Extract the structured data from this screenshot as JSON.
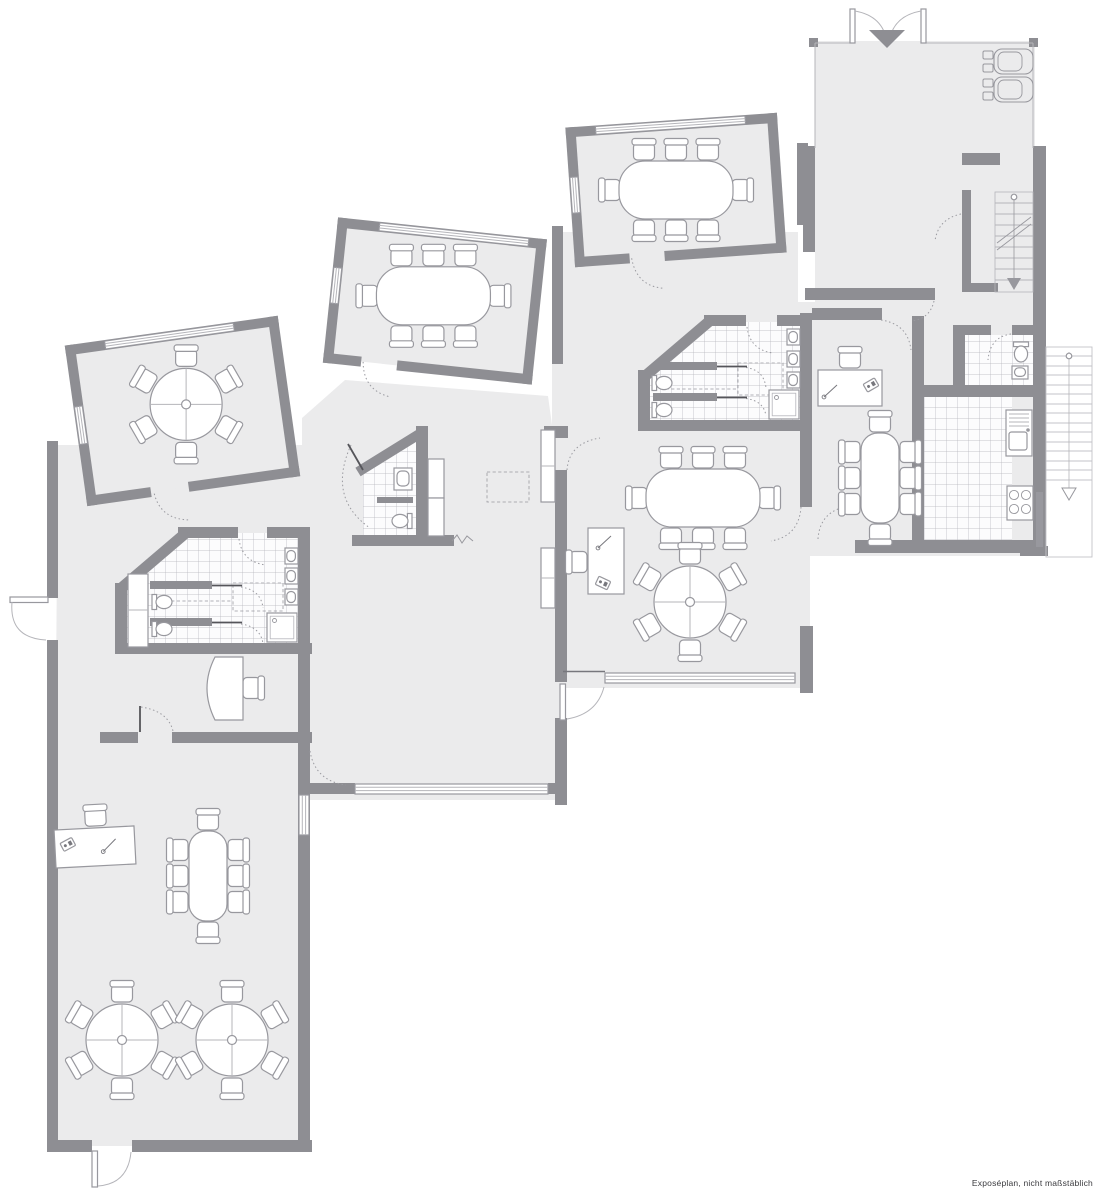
{
  "caption": "Exposéplan, nicht maßstäblich",
  "colors": {
    "background": "#ffffff",
    "floor": "#ebebec",
    "wall": "#8e8e93",
    "furniture_outline": "#98989e",
    "tile_line": "#b4b4ba"
  },
  "plan": {
    "type": "floor-plan",
    "rooms": [
      {
        "id": "meeting-room-west",
        "furniture": [
          "round table",
          "6 chairs"
        ]
      },
      {
        "id": "meeting-room-center",
        "furniture": [
          "oval table",
          "8 chairs"
        ]
      },
      {
        "id": "meeting-room-east",
        "furniture": [
          "oval table",
          "8 chairs"
        ]
      },
      {
        "id": "main-room",
        "furniture": [
          "oval table",
          "8 chairs",
          "round table",
          "6 chairs",
          "desk",
          "desk chair"
        ]
      },
      {
        "id": "office-east",
        "furniture": [
          "desk",
          "desk chair",
          "oval table",
          "8 chairs"
        ]
      },
      {
        "id": "hall-south",
        "furniture": [
          "desk",
          "desk chair",
          "oval table",
          "8 chairs",
          "2 round tables",
          "12 chairs"
        ]
      },
      {
        "id": "office-west",
        "furniture": [
          "curved desk",
          "desk chair"
        ]
      },
      {
        "id": "bathroom-west",
        "furniture": [
          "2 WCs",
          "3 sinks",
          "shower",
          "cabinet"
        ]
      },
      {
        "id": "bathroom-east",
        "furniture": [
          "2 WCs",
          "3 sinks",
          "shower"
        ]
      },
      {
        "id": "wc-center",
        "furniture": [
          "WC",
          "sink"
        ]
      },
      {
        "id": "wc-north",
        "furniture": [
          "WC",
          "sink"
        ]
      },
      {
        "id": "kitchen",
        "furniture": [
          "sink unit",
          "stove"
        ]
      },
      {
        "id": "garage",
        "furniture": [
          "2 cars",
          "double entrance door"
        ]
      },
      {
        "id": "stairwell",
        "furniture": [
          "interior staircase"
        ]
      },
      {
        "id": "exterior-stairs",
        "furniture": [
          "exterior staircase"
        ]
      }
    ]
  }
}
